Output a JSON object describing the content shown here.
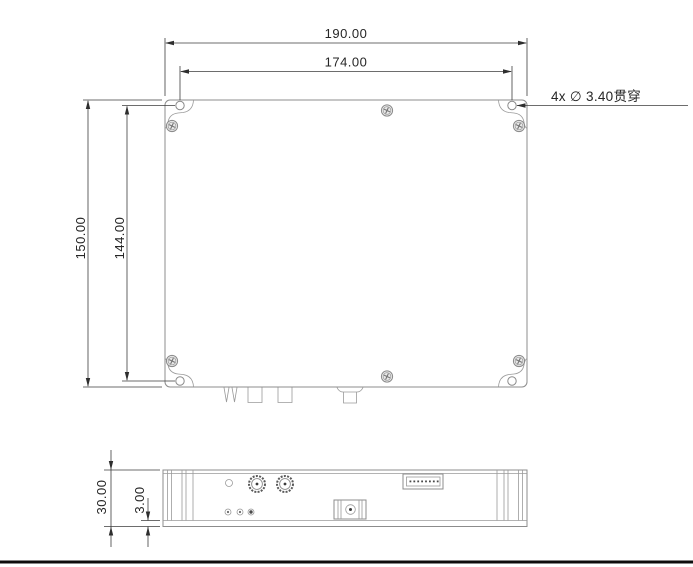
{
  "drawing": {
    "dimensions": {
      "overall_width": "190.00",
      "hole_spacing_width": "174.00",
      "overall_height": "150.00",
      "hole_spacing_height": "144.00",
      "body_thickness": "30.00",
      "base_plate_thickness": "3.00"
    },
    "annotations": {
      "mounting_hole_note": "4x ∅ 3.40贯穿"
    },
    "colors": {
      "part_line": "#8c8c8c",
      "dimension_line": "#3d3d3d",
      "text": "#262626",
      "screw_fill": "#f1f1f1",
      "sheet_border": "#0d0d0d",
      "background": "#ffffff"
    }
  }
}
